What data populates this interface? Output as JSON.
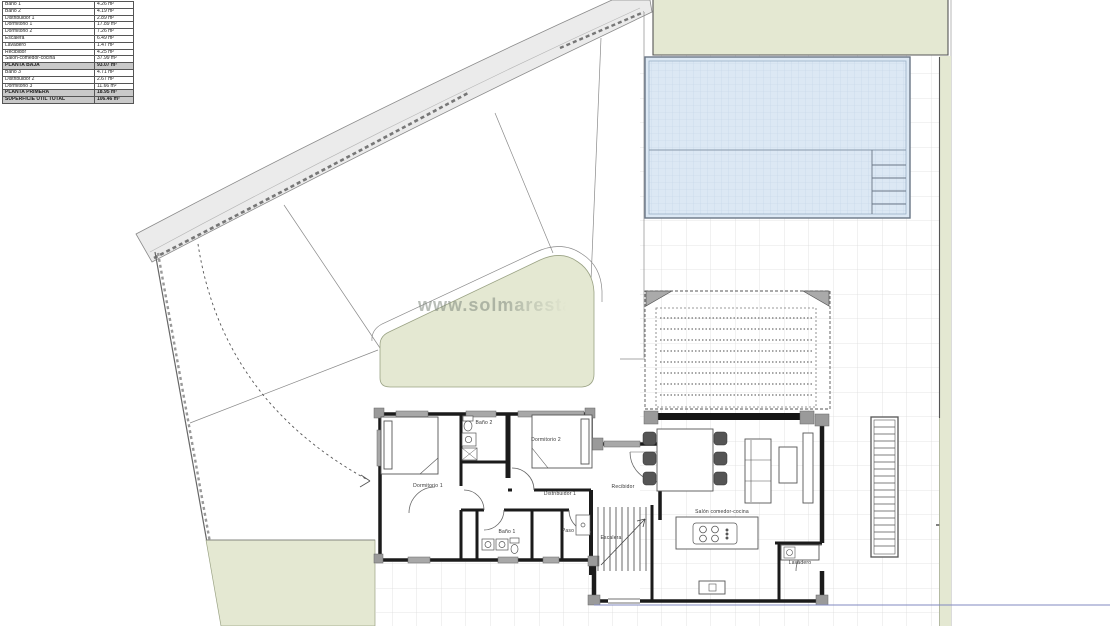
{
  "legend": {
    "rows": [
      {
        "name": "Baño 1",
        "area": "4.26 m²"
      },
      {
        "name": "Baño 2",
        "area": "4.19 m²"
      },
      {
        "name": "Distribuidor 1",
        "area": "2.89 m²"
      },
      {
        "name": "Dormitorio 1",
        "area": "17.89 m²"
      },
      {
        "name": "Dormitorio 2",
        "area": "7.26 m²"
      },
      {
        "name": "Escalera",
        "area": "6.49 m²"
      },
      {
        "name": "Lavadero",
        "area": "1.47 m²"
      },
      {
        "name": "Recibidor",
        "area": "4.25 m²"
      },
      {
        "name": "Salón-comedor-cocina",
        "area": "37.99 m²"
      },
      {
        "name": "PLANTA BAJA",
        "area": "93.07 m²"
      },
      {
        "name": "Baño 3",
        "area": "4.71 m²"
      },
      {
        "name": "Distribuidor 2",
        "area": "2.67 m²"
      },
      {
        "name": "Dormitorio 3",
        "area": "11.66 m²"
      },
      {
        "name": "PLANTA PRIMERA",
        "area": "18.95 m²"
      },
      {
        "name": "SUPERFICIE ÚTIL TOTAL",
        "area": "106.46 m²"
      }
    ]
  },
  "plan": {
    "rooms": {
      "dormitorio1": "Dormitorio 1",
      "bano2": "Baño 2",
      "dormitorio2": "Dormitorio 2",
      "distribuidor1": "Distribuidor 1",
      "recibidor": "Recibidor",
      "bano1": "Baño 1",
      "paso": "Paso",
      "escalera": "Escalera",
      "salon": "Salón comedor-cocina",
      "lavadero": "Lavadero"
    }
  },
  "watermark": "www.solmaresta",
  "colors": {
    "lawn_green": "#e4e8d2",
    "pool_fill": "#dce8f4",
    "pool_grid": "#c3d4e6",
    "road_gray": "#ebebeb",
    "wall_black": "#1b1b1b",
    "window_gray": "#a8a8a8",
    "tile_line": "#dcdcdc",
    "boundary_blue": "#8089c0"
  }
}
